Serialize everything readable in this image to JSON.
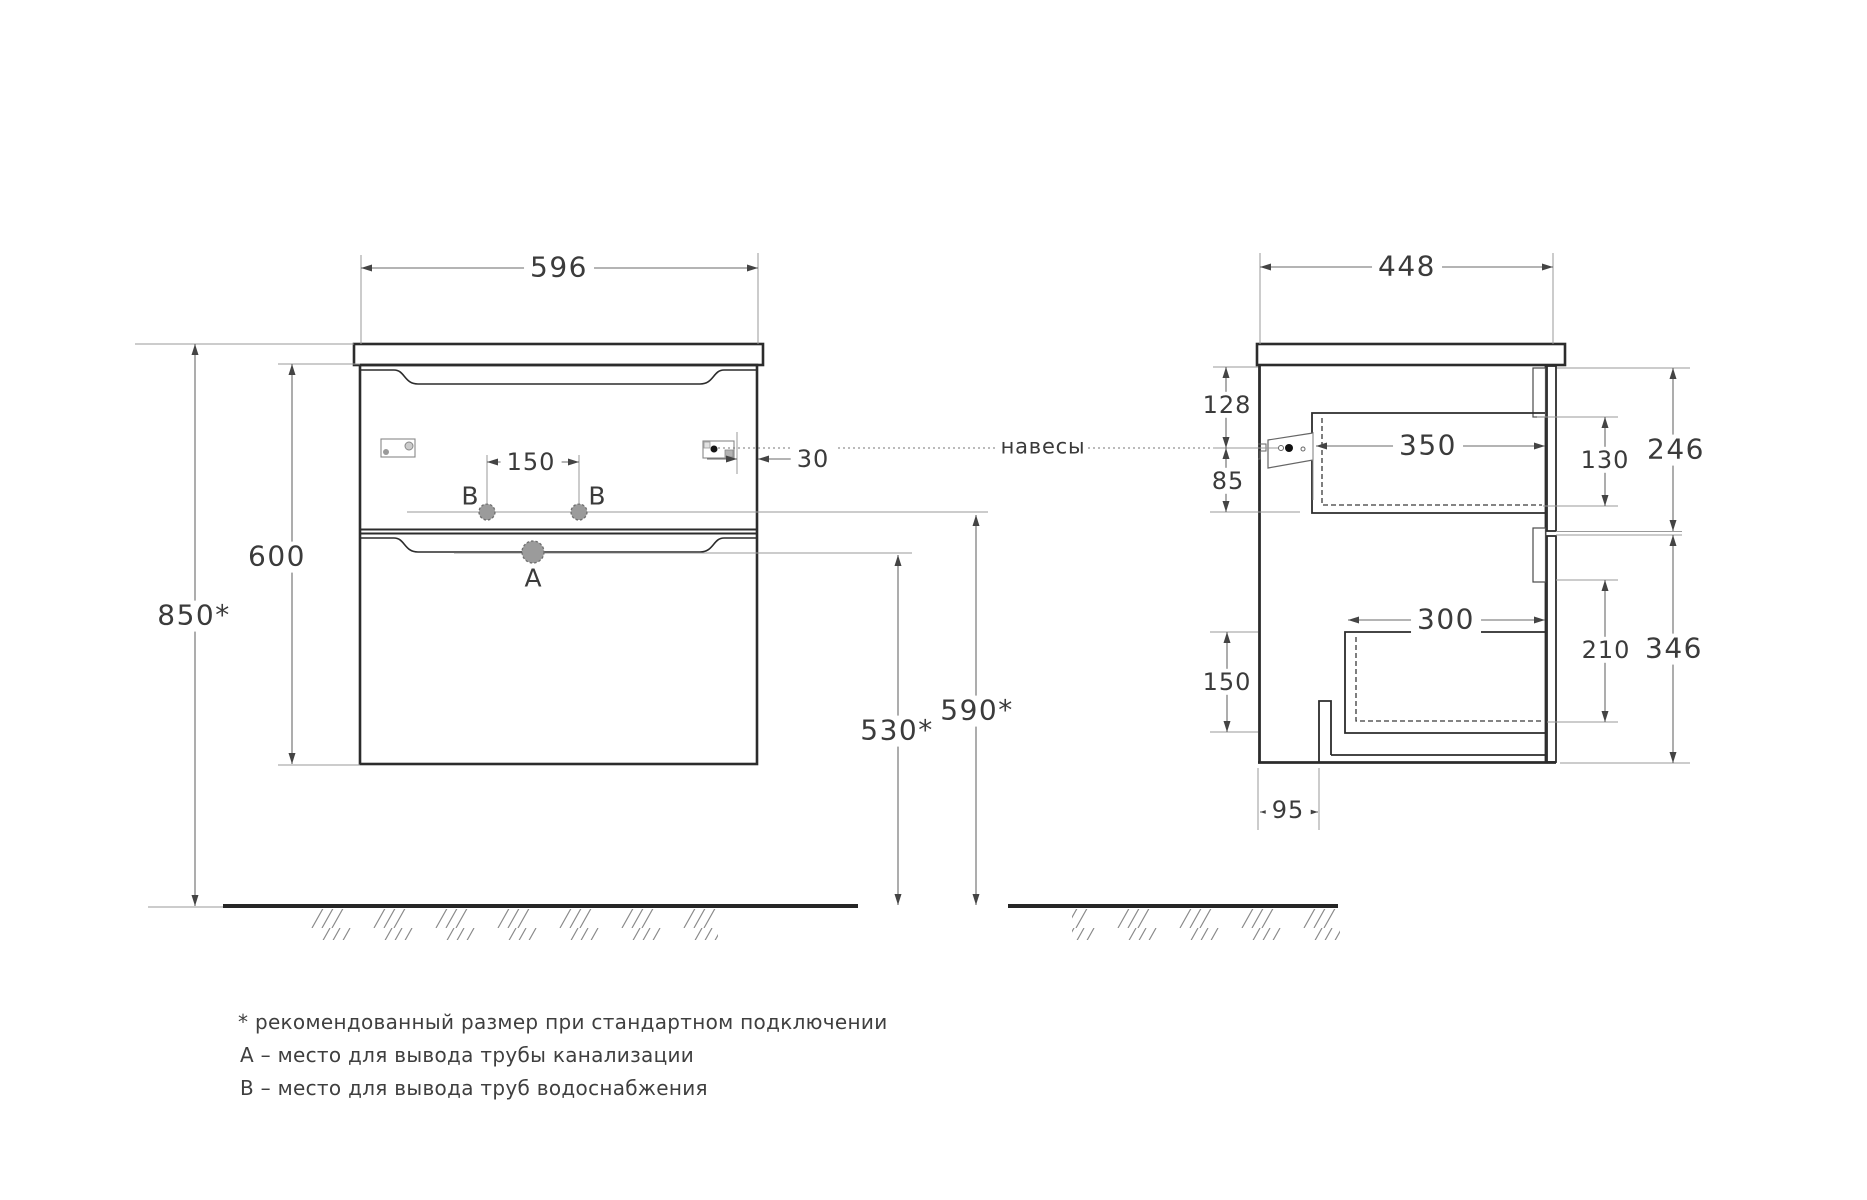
{
  "front": {
    "width": "596",
    "total_height": "850*",
    "cabinet_height": "600",
    "b_spacing": "150",
    "hanger_inset": "30",
    "a_height": "530*",
    "b_height": "590*",
    "label_a": "А",
    "label_b": "В"
  },
  "side": {
    "depth": "448",
    "hanger_drop": "128",
    "hanger_to_drawer": "85",
    "upper_drawer_depth": "350",
    "upper_drawer_inner_height": "130",
    "upper_front_height": "246",
    "lower_drawer_depth": "300",
    "lower_drawer_inner_height": "210",
    "lower_front_height": "346",
    "bottom_offset": "150",
    "notch_offset": "95"
  },
  "labels": {
    "hangers": "навесы"
  },
  "notes": {
    "recommended": "* рекомендованный размер при стандартном подключении",
    "note_a": "А – место для вывода трубы канализации",
    "note_b": "В – место для вывода труб водоснабжения"
  },
  "colors": {
    "line_dark": "#2c2c2c",
    "line_thin": "#9a9a9a",
    "fill_gray": "#9b9b9b",
    "background": "#ffffff"
  }
}
